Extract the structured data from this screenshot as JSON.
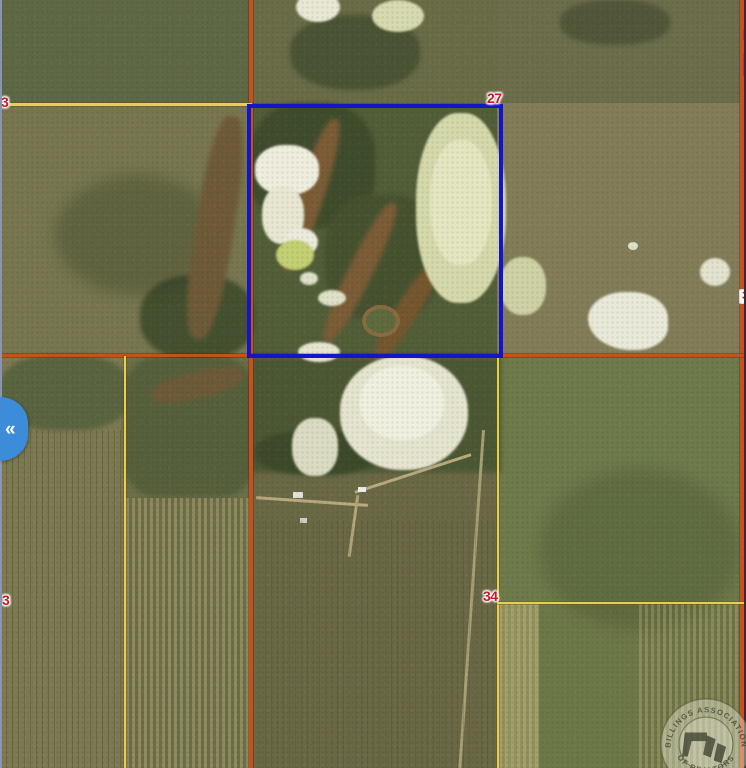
{
  "map": {
    "type": "satellite-parcel-map",
    "section_labels": [
      {
        "id": "left-top",
        "text": "3"
      },
      {
        "id": "center-top",
        "text": "27"
      },
      {
        "id": "right-middle",
        "text": "3"
      },
      {
        "id": "left-bottom",
        "text": "3"
      },
      {
        "id": "center-bottom",
        "text": "34"
      }
    ],
    "colors": {
      "parcel_boundary_blue": "#1414cc",
      "section_line_orange": "#c8501e",
      "section_line_yellow": "#e9cd52",
      "label_red": "#c81a28",
      "toggle_blue": "#3c8cd9"
    }
  },
  "sidebar_toggle": {
    "collapse_icon": "«"
  },
  "watermark": {
    "arc_top": "BILLINGS ASSOCIATION",
    "arc_bottom": "OF REALTORS"
  }
}
